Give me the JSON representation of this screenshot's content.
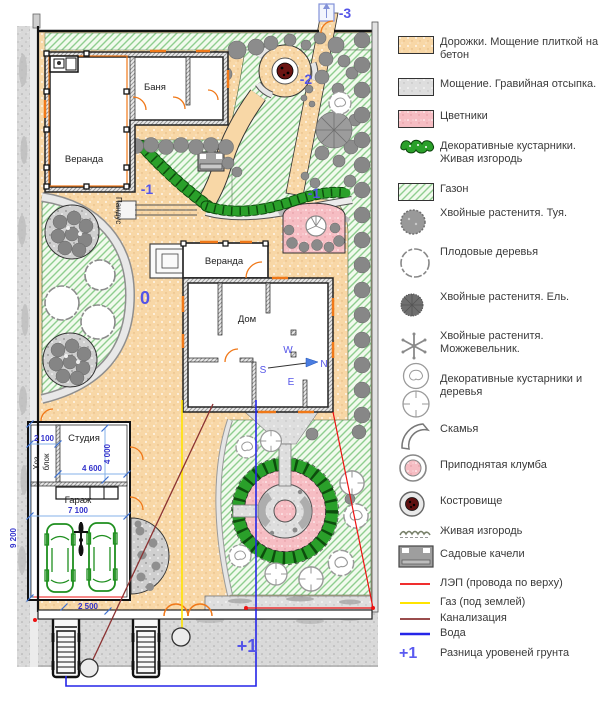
{
  "plan": {
    "labels": {
      "banya": "Баня",
      "bath_veranda": "Веранда",
      "house": "Дом",
      "house_veranda": "Веранда",
      "studio": "Студия",
      "hoz1": "Хоз.",
      "hoz2": "блок",
      "garage": "Гараж",
      "pandus": "Пандус"
    },
    "levels": {
      "zero": "0",
      "minus1_left": "-1",
      "minus1_right": "-1",
      "minus2": "-2",
      "minus3": "-3",
      "plus1": "+1"
    },
    "compass": {
      "w": "W",
      "n": "N",
      "s": "S",
      "e": "E"
    },
    "dimensions": {
      "hoz_width": "2 100",
      "studio_width": "4 600",
      "studio_depth": "4 000",
      "garage_width": "7 100",
      "garage_depth": "9 200",
      "gate_width": "2 500"
    }
  },
  "legend": {
    "items": [
      {
        "name": "paths",
        "label": "Дорожки. Мощение плиткой на бетон"
      },
      {
        "name": "gravel",
        "label": "Мощение. Гравийная отсыпка."
      },
      {
        "name": "flowerbeds",
        "label": "Цветники"
      },
      {
        "name": "shrubs-hedge",
        "label": "Декоративные кустарники. Живая изгородь"
      },
      {
        "name": "lawn",
        "label": "Газон"
      },
      {
        "name": "thuja",
        "label": "Хвойные растенитя. Туя."
      },
      {
        "name": "fruit-trees",
        "label": "Плодовые деревья"
      },
      {
        "name": "spruce",
        "label": "Хвойные растенитя. Ель."
      },
      {
        "name": "juniper",
        "label": "Хвойные растенитя. Можжевельник."
      },
      {
        "name": "decorative-shrubs-trees",
        "label": "Декоративные кустарники и деревья"
      },
      {
        "name": "bench",
        "label": "Скамья"
      },
      {
        "name": "raised-bed",
        "label": "Приподнятая клумба"
      },
      {
        "name": "fire-pit",
        "label": "Костровище"
      },
      {
        "name": "hedge",
        "label": "Живая изгородь"
      },
      {
        "name": "garden-swing",
        "label": "Садовые качели"
      },
      {
        "name": "power-line",
        "label": "ЛЭП (провода по верху)"
      },
      {
        "name": "gas",
        "label": "Газ (под землей)"
      },
      {
        "name": "sewer",
        "label": "Канализация"
      },
      {
        "name": "water",
        "label": "Вода"
      },
      {
        "name": "ground-level",
        "symbol": "+1",
        "label": "Разница уровеней грунта"
      }
    ]
  },
  "colors": {
    "path_orange": "#F8D7A6",
    "gravel_gray": "#DEDEDE",
    "flowerbed_pink": "#F6BDC3",
    "hedge_green": "#2AA02A",
    "lawn_hatch_green": "#8FCE8F",
    "lep_red": "#EE1111",
    "gas_yellow": "#FFE400",
    "sewer_dark_red": "#8B3232",
    "water_blue": "#2525E8",
    "level_label_blue": "#5454E8",
    "dimension_blue": "#3333CC",
    "fire_pit_dark_red": "#6B1412",
    "car_green": "#1F8F1F"
  }
}
